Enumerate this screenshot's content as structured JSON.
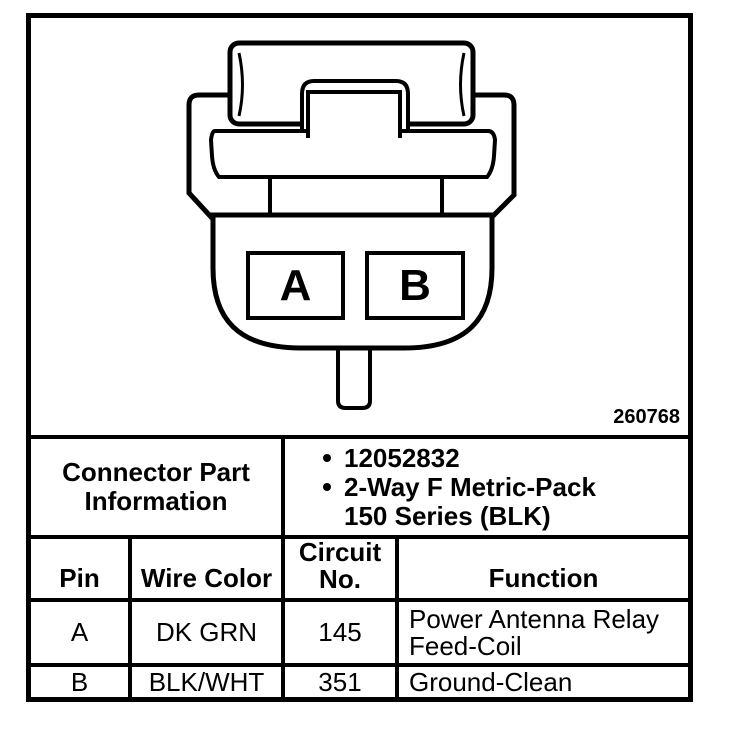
{
  "figure": {
    "pin_a": "A",
    "pin_b": "B",
    "figure_number": "260768"
  },
  "connector_info": {
    "title_line1": "Connector Part",
    "title_line2": "Information",
    "bullet1": "12052832",
    "bullet2_line1": "2-Way F Metric-Pack",
    "bullet2_line2": "150 Series (BLK)"
  },
  "table": {
    "headers": {
      "pin": "Pin",
      "wire_color": "Wire Color",
      "circuit_line1": "Circuit",
      "circuit_line2": "No.",
      "function": "Function"
    },
    "rows": [
      {
        "pin": "A",
        "wire_color": "DK GRN",
        "circuit": "145",
        "function": "Power Antenna Relay Feed-Coil"
      },
      {
        "pin": "B",
        "wire_color": "BLK/WHT",
        "circuit": "351",
        "function": "Ground-Clean"
      }
    ]
  },
  "colors": {
    "ink": "#000000",
    "paper": "#ffffff"
  }
}
